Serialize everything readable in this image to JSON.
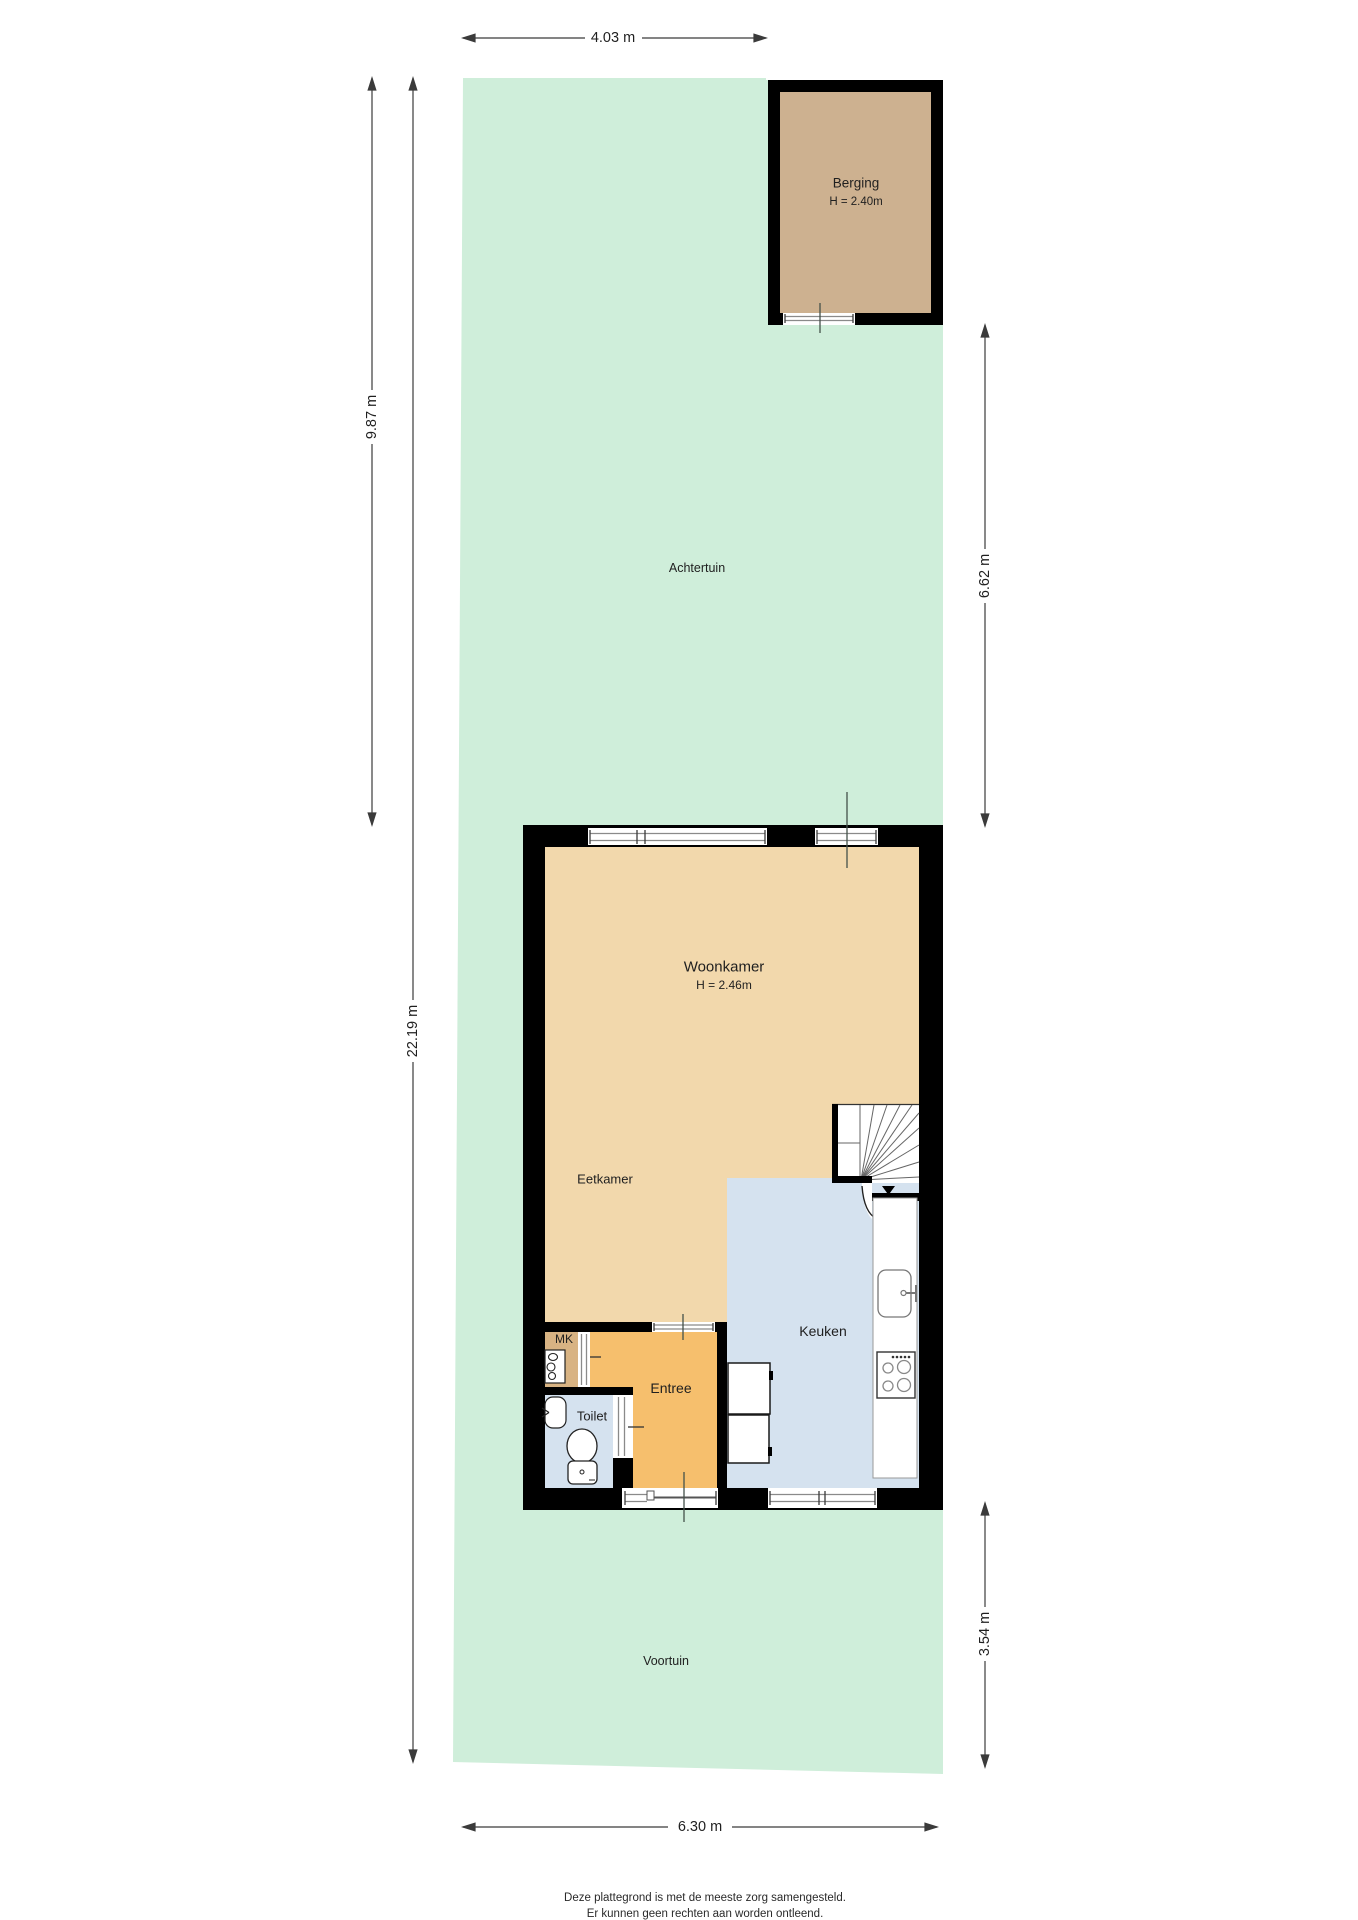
{
  "plan": {
    "rooms": {
      "berging": {
        "label": "Berging",
        "height": "H = 2.40m"
      },
      "achtertuin": {
        "label": "Achtertuin"
      },
      "woonkamer": {
        "label": "Woonkamer",
        "height": "H = 2.46m"
      },
      "eetkamer": {
        "label": "Eetkamer"
      },
      "keuken": {
        "label": "Keuken"
      },
      "entree": {
        "label": "Entree"
      },
      "toilet": {
        "label": "Toilet"
      },
      "mk": {
        "label": "MK"
      },
      "voortuin": {
        "label": "Voortuin"
      }
    },
    "dimensions": {
      "top_width": "4.03 m",
      "back_garden_depth": "9.87 m",
      "total_depth": "22.19 m",
      "right_back": "6.62 m",
      "front_garden_depth": "3.54 m",
      "bottom_width": "6.30 m"
    },
    "disclaimer": {
      "line1": "Deze plattegrond is met de meeste zorg samengesteld.",
      "line2": "Er kunnen geen rechten aan worden ontleend."
    },
    "colors": {
      "garden": "#cfeeda",
      "floor": "#f2d8ac",
      "berging_floor": "#cdb190",
      "entree_floor": "#f6bf6d",
      "kitchen_floor": "#d5e2ef",
      "mk_floor": "#d8b383",
      "wall": "#000000"
    }
  }
}
